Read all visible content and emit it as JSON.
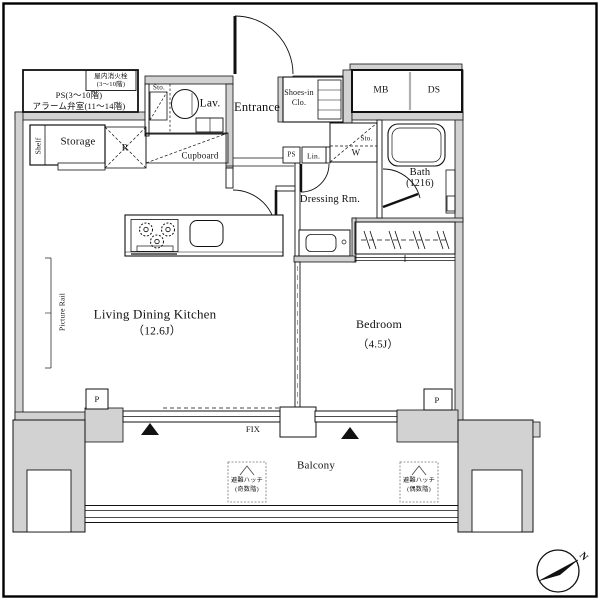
{
  "plan": {
    "utility": {
      "hydrant_l1": "屋内消火栓",
      "hydrant_l2": "(3～10階)",
      "ps_riser_l1": "PS(3～10階)",
      "ps_riser_l2": "アラーム弁室(11～14階)",
      "mb": "MB",
      "ds": "DS",
      "ps_small": "PS",
      "linen": "Lin."
    },
    "rooms": {
      "entrance": "Entrance",
      "lavatory": "Lav.",
      "lav_storage": "Sto.",
      "shoes_l1": "Shoes-in",
      "shoes_l2": "Clo.",
      "storage": "Storage",
      "shelf": "Shelf",
      "refrigerator": "R",
      "cupboard": "Cupboard",
      "sto_over_washer": "Sto.",
      "washer": "W",
      "bath_l1": "Bath",
      "bath_l2": "(1216)",
      "dressing": "Dressing Rm.",
      "ldk_l1": "Living Dining Kitchen",
      "ldk_l2": "（12.6J）",
      "bedroom_l1": "Bedroom",
      "bedroom_l2": "（4.5J）",
      "balcony": "Balcony",
      "picture_rail": "Picture Rail"
    },
    "openings": {
      "fix_window": "FIX",
      "pillar_left": "P",
      "pillar_right": "P"
    },
    "balcony_items": {
      "hatch_odd_l1": "避難ハッチ",
      "hatch_odd_l2": "(奇数階)",
      "hatch_even_l1": "避難ハッチ",
      "hatch_even_l2": "(偶数階)"
    },
    "compass": {
      "north": "N"
    },
    "colors": {
      "wall_fill": "#d2d2d2",
      "line": "#111111",
      "background": "#ffffff"
    }
  }
}
